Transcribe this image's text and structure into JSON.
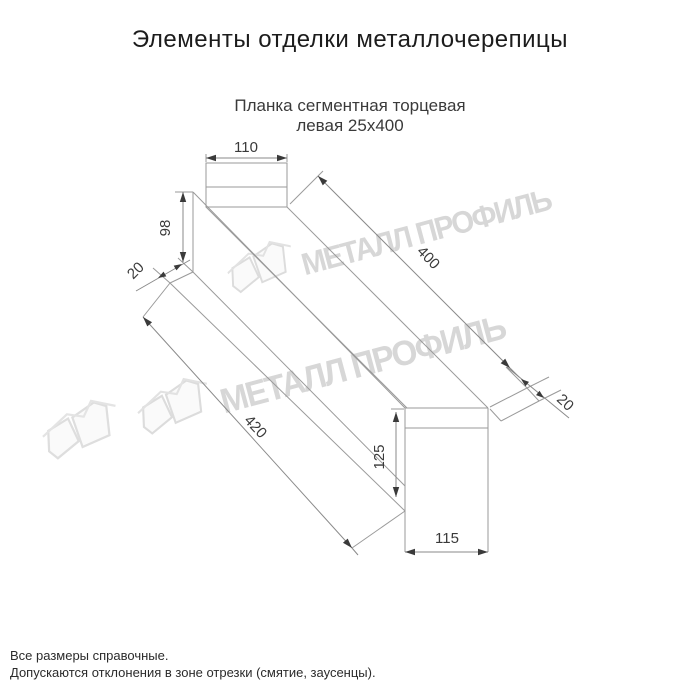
{
  "page": {
    "title": "Элементы отделки металлочерепицы",
    "subtitle": {
      "line1": "Планка сегментная торцевая",
      "line2": "левая 25х400"
    },
    "footer": {
      "line1": "Все размеры справочные.",
      "line2": "Допускаются отклонения в зоне отрезки (смятие, заусенцы)."
    }
  },
  "watermark": {
    "text": "МЕТАЛЛ ПРОФИЛЬ",
    "color": "#d7d7d7"
  },
  "drawing": {
    "part_dimensions_mm": {
      "top_flange_width": "110",
      "left_end_height": "98",
      "left_hem": "20",
      "top_edge_length": "400",
      "bottom_edge_length": "420",
      "right_hem": "20",
      "right_end_height": "125",
      "bottom_flange_width": "115"
    },
    "line_color": "#9a9a9a",
    "dim_text_color": "#3a3a3a"
  }
}
